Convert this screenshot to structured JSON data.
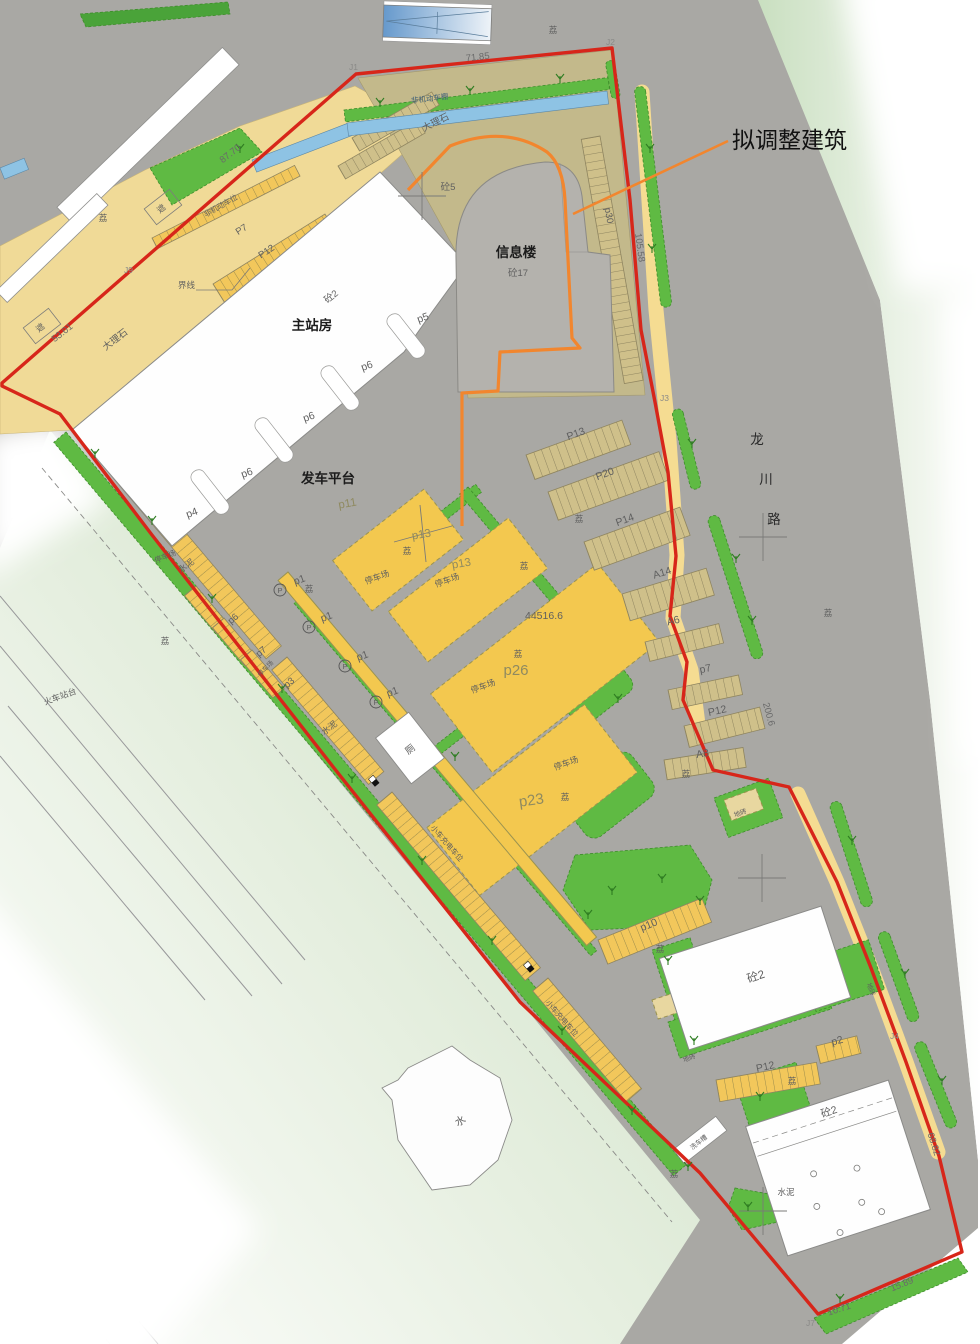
{
  "callout": {
    "label": "拟调整建筑"
  },
  "roads": {
    "longchuan": {
      "char1": "龙",
      "char2": "川",
      "char3": "路"
    },
    "railway_platform": "火车站台"
  },
  "buildings": {
    "main_station": "主站房",
    "info_building": "信息楼",
    "concrete2": "砼2",
    "concrete5": "砼5",
    "concrete17": "砼17",
    "toilet": "厕",
    "water_building": "水",
    "car_wash": "洗车槽",
    "shelter": "遮",
    "non_motor_shed": "非机动车棚"
  },
  "site": {
    "departure_platform": "发车平台",
    "marble": "大理石",
    "parking_lot": "停车场",
    "non_motor_spaces": "非机动车位",
    "ev_spaces": "小车充电车位",
    "boundary_line_label": "界线",
    "cement": "水泥",
    "tile": "地砖",
    "area_number": "44516.6",
    "tree_mark": "荔",
    "p_icon": "P"
  },
  "parking_spots": {
    "p1": "p1",
    "p2": "p2",
    "p3": "p3",
    "p4": "p4",
    "p5": "p5",
    "p6": "p6",
    "p7_lower": "p7",
    "p7_upper": "P7",
    "p10": "p10",
    "p11": "p11",
    "p12_upper": "P12",
    "p12_right": "P12",
    "p12_lower": "P12",
    "p13_main": "p13",
    "p13_right": "P13",
    "p14": "P14",
    "p20": "P20",
    "p23": "p23",
    "p26": "p26",
    "p30": "p30",
    "a6": "A6",
    "a8": "A8",
    "a14": "A14"
  },
  "boundary": {
    "points": {
      "j1": "J1",
      "j2": "J2",
      "j3": "J3",
      "j4": "J4",
      "j7": "J7",
      "j9": "J9"
    },
    "dimensions": {
      "top": "71.85",
      "upper_left": "87.70",
      "left": "53.01",
      "right_upper": "105.58",
      "right_middle": "200.6",
      "right_lower": "68.82",
      "bottom_left": "10.71",
      "bottom_right": "15.89"
    }
  },
  "colors": {
    "boundary_red": "#d7261a",
    "proposal_orange": "#f2862e",
    "lot_yellow": "#f3c84f",
    "marble_yellow": "#f0da97",
    "olive_tan": "#c3b98b",
    "green": "#5fba43",
    "road_gray": "#a9a8a4",
    "canopy_blue": "#8ec3e4"
  }
}
